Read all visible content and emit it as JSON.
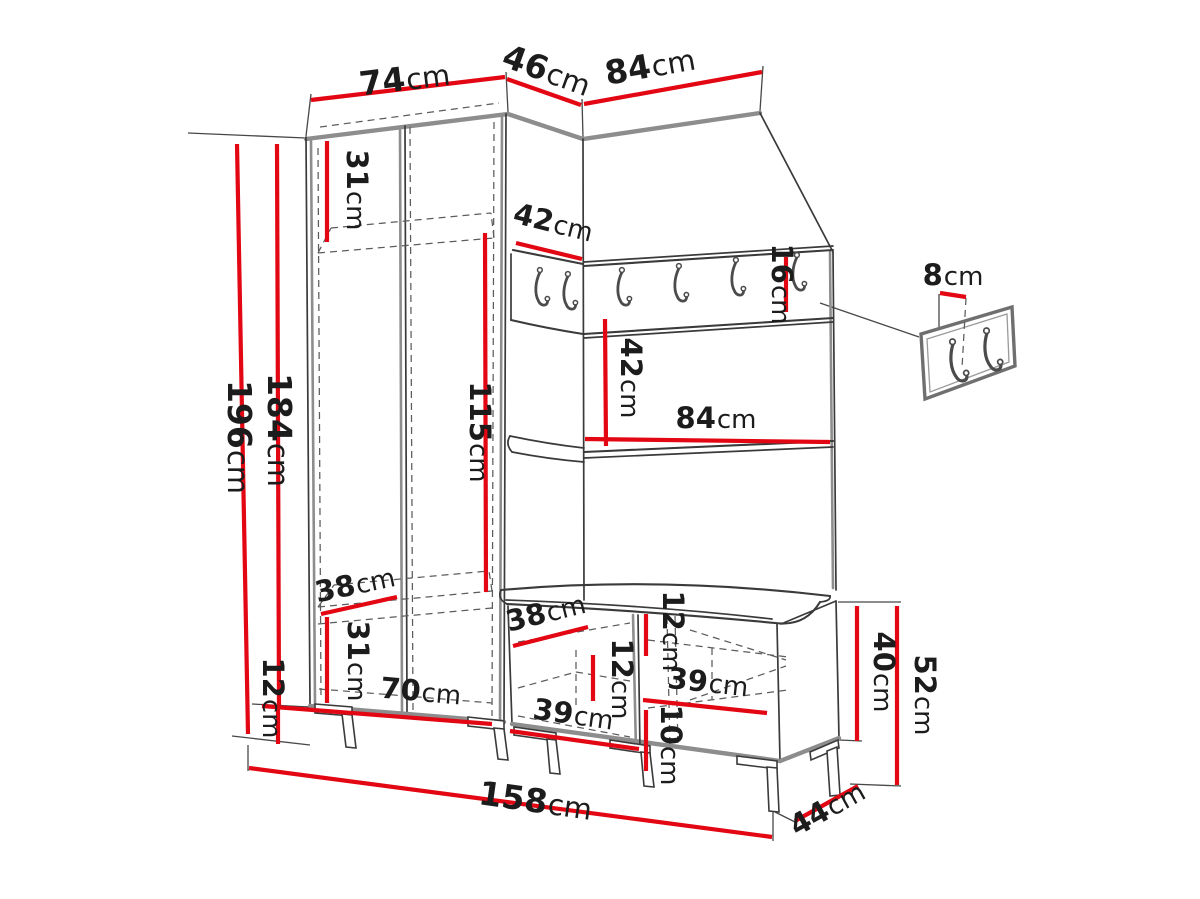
{
  "diagram": {
    "type": "furniture-dimension-drawing",
    "subject": "hallway set: wardrobe, hook panel with mirror, storage bench, wall hook plate",
    "unit": "cm",
    "accent_color": "#e30613",
    "outline_color": "#3a3a3a",
    "edge_color": "#8d8d8d",
    "label_color": "#1c1c1c",
    "dims": {
      "top_wardrobe_width": {
        "value": "74",
        "unit": "cm"
      },
      "top_corner_depth": {
        "value": "46",
        "unit": "cm"
      },
      "top_panel_width": {
        "value": "84",
        "unit": "cm"
      },
      "total_height": {
        "value": "196",
        "unit": "cm"
      },
      "body_height": {
        "value": "184",
        "unit": "cm"
      },
      "upper_shelf_height": {
        "value": "31",
        "unit": "cm"
      },
      "corner_shelf_width": {
        "value": "42",
        "unit": "cm"
      },
      "hanger_board_height": {
        "value": "16",
        "unit": "cm"
      },
      "mirror_height": {
        "value": "42",
        "unit": "cm"
      },
      "panel_inner_width": {
        "value": "84",
        "unit": "cm"
      },
      "hanging_space_height": {
        "value": "115",
        "unit": "cm"
      },
      "upper_shelf_depth": {
        "value": "38",
        "unit": "cm"
      },
      "lower_shelf_height": {
        "value": "31",
        "unit": "cm"
      },
      "leg_height": {
        "value": "12",
        "unit": "cm"
      },
      "wardrobe_inner_width": {
        "value": "70",
        "unit": "cm"
      },
      "bench_shelf_depth": {
        "value": "38",
        "unit": "cm"
      },
      "bench_top_thickness": {
        "value": "12",
        "unit": "cm"
      },
      "bench_inner_height": {
        "value": "12",
        "unit": "cm"
      },
      "bench_left_inner_width": {
        "value": "39",
        "unit": "cm"
      },
      "bench_right_inner_width": {
        "value": "39",
        "unit": "cm"
      },
      "bench_plinth_height": {
        "value": "10",
        "unit": "cm"
      },
      "bench_box_height": {
        "value": "40",
        "unit": "cm"
      },
      "bench_total_height": {
        "value": "52",
        "unit": "cm"
      },
      "bench_depth": {
        "value": "44",
        "unit": "cm"
      },
      "total_width": {
        "value": "158",
        "unit": "cm"
      },
      "hook_plate_offset": {
        "value": "8",
        "unit": "cm"
      }
    }
  }
}
